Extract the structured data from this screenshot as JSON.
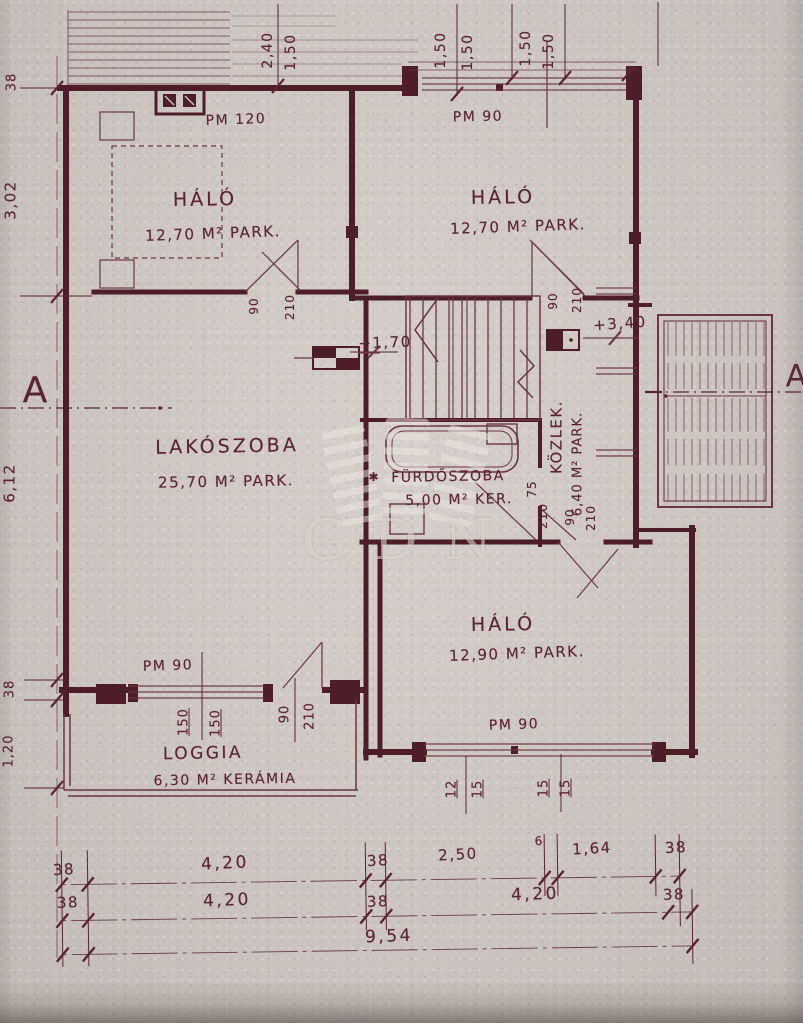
{
  "style": {
    "ink": "#5b2431",
    "wall": "#4d1e29",
    "paper": "#ccc4bf",
    "watermark": "#ece6df"
  },
  "rooms": {
    "halo_tl": {
      "name": "HÁLÓ",
      "area": "12,70 M² PARK."
    },
    "halo_tr": {
      "name": "HÁLÓ",
      "area": "12,70 M² PARK."
    },
    "lakoszoba": {
      "name": "LAKÓSZOBA",
      "area": "25,70 M² PARK."
    },
    "furdoszoba": {
      "name": "FÜRDŐSZOBA",
      "area": "5,00 M² KER.",
      "note": "✱"
    },
    "kozlekedo": {
      "name": "KÖZLEK.",
      "area": "6,40 M² PARK."
    },
    "halo_br": {
      "name": "HÁLÓ",
      "area": "12,90 M² PARK."
    },
    "loggia": {
      "name": "LOGGIA",
      "area": "6,30 M² KERÁMIA"
    }
  },
  "openings": {
    "window_halo_tl": "PM 120",
    "entry_door": "PM 90",
    "window_halo_br": "PM 90",
    "window_loggia": "PM 90"
  },
  "levels": {
    "stair_landing": "+1,70",
    "upper_floor": "+3,40"
  },
  "section_marks": {
    "left": "A",
    "right": "A"
  },
  "door_sizes": {
    "halo_tl_door": {
      "w": "90",
      "h": "210"
    },
    "halo_tr_door": {
      "w": "90",
      "h": "210"
    },
    "halo_br_door": {
      "w": "90",
      "h": "210"
    },
    "bath_door": {
      "w": "75",
      "h": "210"
    },
    "loggia_door": {
      "w": "90",
      "h": "210"
    }
  },
  "window_marks": {
    "halo_br": [
      "12",
      "15",
      "15",
      "15"
    ],
    "loggia": [
      "150",
      "150"
    ]
  },
  "dimensions": {
    "top": [
      "2,40",
      "1,50",
      "1,50",
      "1,50",
      "1,50",
      "1,50"
    ],
    "left": [
      "38",
      "3,02",
      "6,12",
      "38",
      "1,20"
    ],
    "bottom_row1": [
      "38",
      "4,20",
      "38",
      "2,50",
      "6",
      "1,64",
      "38"
    ],
    "bottom_row2": [
      "38",
      "4,20",
      "38",
      "4,20",
      "38"
    ],
    "total_width": "9,54"
  },
  "watermark": {
    "text": "GDN"
  }
}
